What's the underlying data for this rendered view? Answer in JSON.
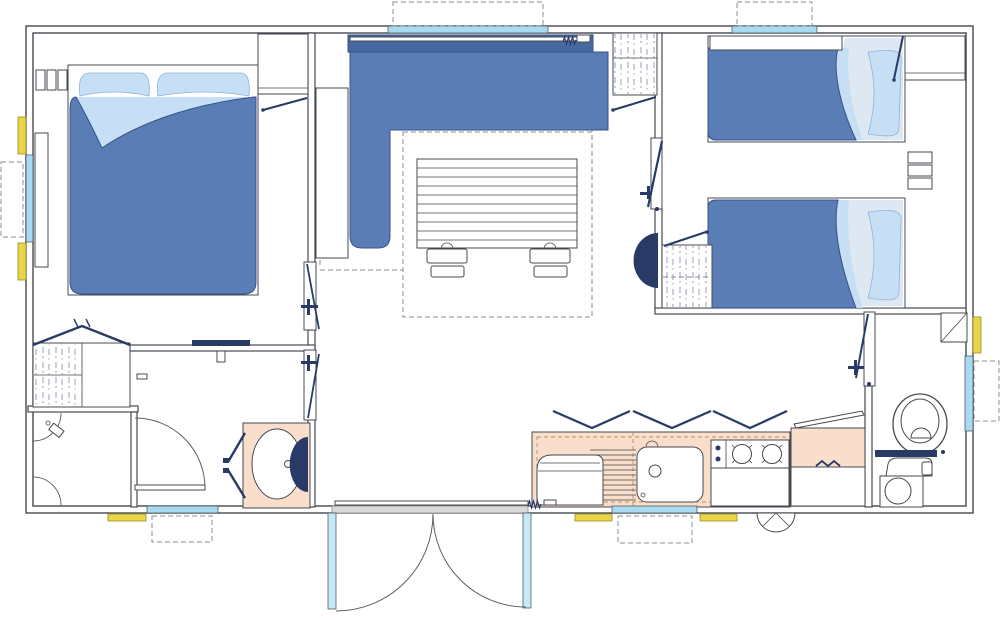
{
  "meta": {
    "title": "Mobile home floor plan (2 bedrooms)",
    "type": "floor-plan",
    "text_labels": []
  },
  "palette": {
    "background": "#ffffff",
    "outline": "#45494f",
    "navy": "#2a3a66",
    "furniture_blue": "#5b7db6",
    "furniture_blue_dark": "#47699f",
    "furniture_stroke": "#35528c",
    "bedding_light": "#c7dff4",
    "bedding_pale": "#dde8f2",
    "window_blue": "#a8daf0",
    "glass_pale": "#c6e9f7",
    "accent_yellow": "#e8d54b",
    "counter_peach": "#f8decb",
    "hatch_gray": "#98a0ac",
    "threshold_gray": "#d8d8d8",
    "dash_gray": "#8a8f94"
  },
  "rooms": [
    {
      "name": "master-bedroom",
      "fixtures": [
        "double-bed",
        "pillows",
        "tall-wardrobe",
        "bedside-shelves",
        "wardrobe-with-hanging-rail",
        "window"
      ]
    },
    {
      "name": "living-area",
      "fixtures": [
        "l-shaped-sofa",
        "slatted-table",
        "two-stools",
        "curtain-rail",
        "hanging-wardrobe",
        "panoramic-window"
      ]
    },
    {
      "name": "kitchen",
      "fixtures": [
        "fridge",
        "draining-board",
        "sink",
        "two-burner-hob",
        "worktop",
        "overhead-cabinets",
        "flip-top-unit",
        "window",
        "gas-vent"
      ]
    },
    {
      "name": "hallway",
      "fixtures": [
        "shelf-rail",
        "washbasin-vanity",
        "window"
      ]
    },
    {
      "name": "shower-room",
      "fixtures": [
        "corner-shower-tray",
        "shower-head",
        "hinged-door"
      ]
    },
    {
      "name": "twin-bedroom",
      "fixtures": [
        "single-bed-top",
        "single-bed-bottom",
        "between-bed-shelves",
        "overhead-lockers",
        "hanging-wardrobe",
        "window"
      ]
    },
    {
      "name": "wc",
      "fixtures": [
        "toilet",
        "cistern",
        "washbasin-cabinet",
        "corner-shelf",
        "window"
      ]
    }
  ],
  "openings": {
    "entrance": "double-french-door",
    "internal_doors": 6,
    "windows": 7,
    "awning_markers_dashed": 7,
    "step_markers_yellow": 6
  }
}
